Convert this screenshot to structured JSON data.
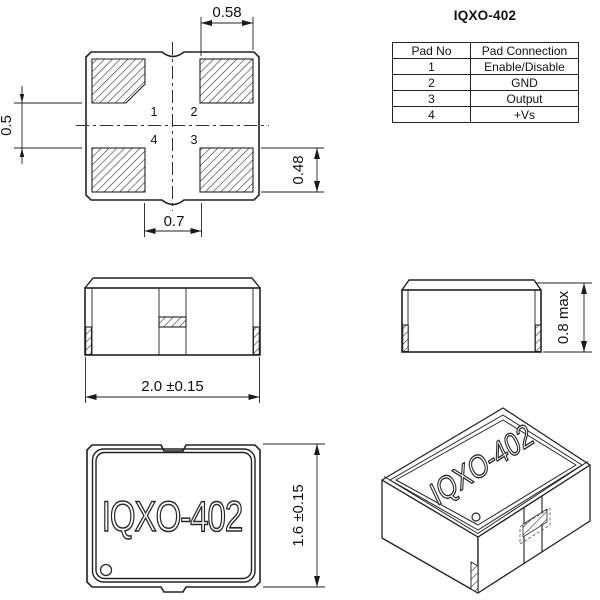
{
  "page": {
    "background": "#ffffff",
    "line_color": "#222222"
  },
  "pad_table": {
    "title": "IQXO-402",
    "headers": [
      "Pad No",
      "Pad Connection"
    ],
    "rows": [
      {
        "pad_no": "1",
        "connection": "Enable/Disable"
      },
      {
        "pad_no": "2",
        "connection": "GND"
      },
      {
        "pad_no": "3",
        "connection": "Output"
      },
      {
        "pad_no": "4",
        "connection": "+Vs"
      }
    ]
  },
  "footprint": {
    "dim_top_width": "0.58",
    "dim_left_gap": "0.5",
    "dim_right_pad_height": "0.48",
    "dim_bottom_gap": "0.7",
    "pad_numbers": {
      "pad1": "1",
      "pad2": "2",
      "pad3": "3",
      "pad4": "4"
    }
  },
  "front_view": {
    "dim_width": "2.0 ±0.15"
  },
  "end_view": {
    "dim_height": "0.8 max"
  },
  "top_view": {
    "part_label": "IQXO-402",
    "dim_height": "1.6 ±0.15"
  },
  "iso_view": {
    "part_label": "IQXO-402"
  }
}
